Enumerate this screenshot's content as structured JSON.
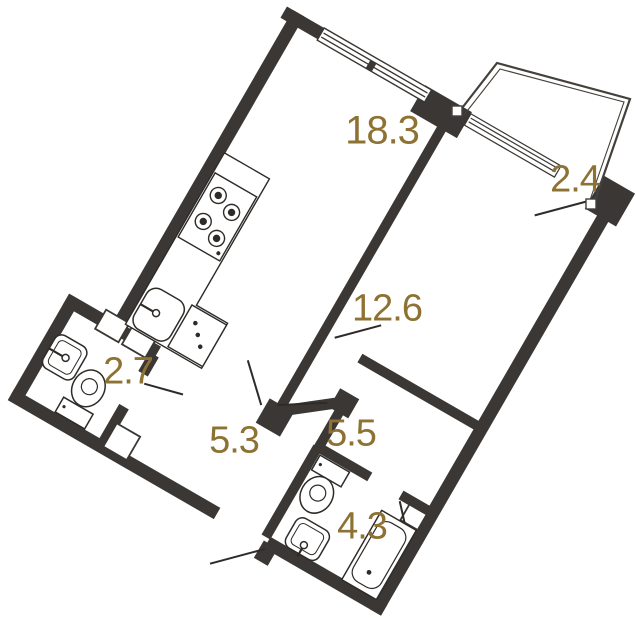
{
  "plan": {
    "kind": "apartment floor plan",
    "rotation_degrees": 30,
    "colors": {
      "wall": "#3a3734",
      "fixture_line": "#2e2b28",
      "area_label": "#8d7233",
      "floor": "#ffffff"
    },
    "rooms": [
      {
        "id": "living-kitchen",
        "area_label": "18.3"
      },
      {
        "id": "balcony",
        "area_label": "2.4"
      },
      {
        "id": "bedroom",
        "area_label": "12.6"
      },
      {
        "id": "wc",
        "area_label": "2.7"
      },
      {
        "id": "hallway",
        "area_label": "5.3"
      },
      {
        "id": "inner-hallway",
        "area_label": "5.5"
      },
      {
        "id": "bathroom",
        "area_label": "4.3"
      }
    ],
    "fixtures": [
      "stove-4-burners",
      "kitchen-sink",
      "washing-machine",
      "wc-sink",
      "wc-toilet",
      "bathroom-toilet",
      "bathroom-sink",
      "bathtub",
      "ventilation-shafts"
    ],
    "openings": [
      "living-room-window",
      "bedroom-window",
      "balcony-door",
      "bedroom-door",
      "wc-door",
      "bathroom-door",
      "hall-doors",
      "entrance-door"
    ]
  }
}
